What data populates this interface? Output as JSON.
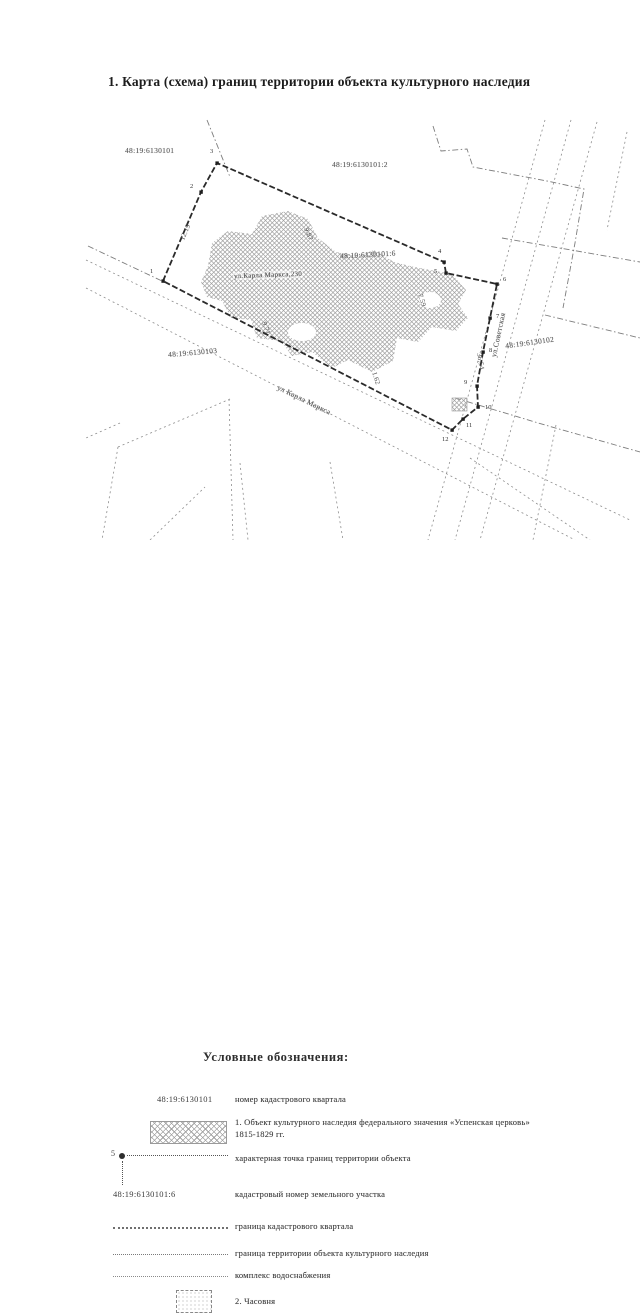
{
  "page": {
    "title": "1. Карта (схема) границ территории объекта культурного наследия"
  },
  "map": {
    "labels": {
      "quarter_top_left": "48:19:6130101",
      "parcel_top": "48:19:6130101:2",
      "parcel_church": "48:19:6130101:6",
      "quarter_right": "48:19:6130102",
      "quarter_left": "48:19:6130103",
      "street_karl_marks": "ул Карла Маркса",
      "street_sovetskaya": "ул.Советская",
      "object_address": "ул.Карла Маркса,230"
    },
    "distance_labels": [
      "12.19",
      "9.87",
      "7.59",
      "36.54",
      "9.71",
      "1.62"
    ],
    "point_labels": [
      "1",
      "2",
      "3",
      "4",
      "5",
      "6",
      "7",
      "8",
      "9",
      "10",
      "11",
      "12"
    ]
  },
  "legend": {
    "heading": "Условные обозначения:",
    "rows": [
      {
        "code": "48:19:6130101",
        "text": "номер кадастрового квартала"
      },
      {
        "text": "1. Объект культурного наследия федерального значения «Успенская церковь» 1815-1829 гг."
      },
      {
        "point_number": "5",
        "text": "характерная точка границ территории объекта"
      },
      {
        "code": "48:19:6130101:6",
        "text": "кадастровый номер земельного участка"
      },
      {
        "text": "граница кадастрового квартала"
      },
      {
        "text": "граница территории объекта культурного наследия"
      },
      {
        "text": "комплекс водоснабжения"
      },
      {
        "text": "2. Часовня"
      }
    ]
  },
  "colors": {
    "boundary": "#2a2a2a",
    "map_line": "#8d8d8d",
    "hatch": "#a2a2a2",
    "text": "#3c3c3c"
  }
}
